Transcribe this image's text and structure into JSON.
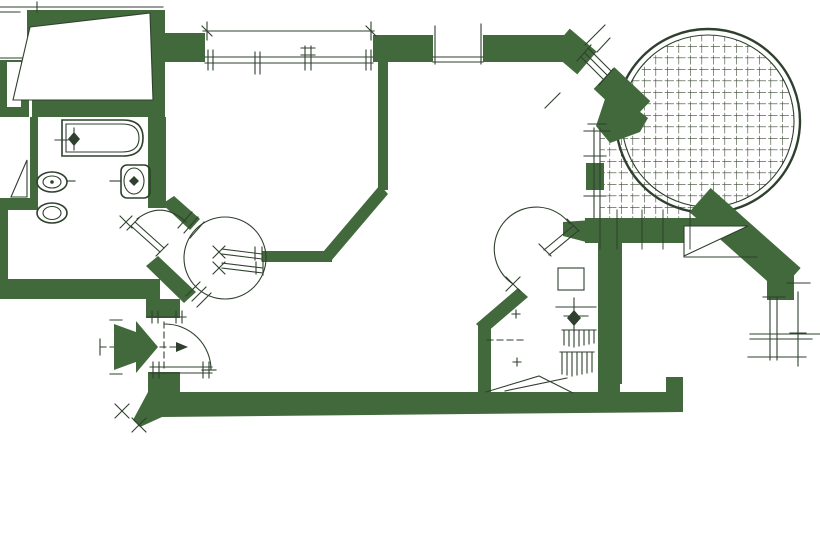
{
  "meta": {
    "kind": "architectural-floor-plan",
    "style": "scanned hand-drafted plan, dark green ink on white paper",
    "text_labels": []
  },
  "palette": {
    "background": "#ffffff",
    "wall_fill": "#42693c",
    "line": "#2f402e",
    "grid_line": "#3a4733"
  },
  "plan": {
    "rooms": [
      {
        "name": "bathroom",
        "fixtures": [
          "bathtub",
          "bidet",
          "toilet",
          "washbasin"
        ]
      },
      {
        "name": "top-room"
      },
      {
        "name": "living-area"
      },
      {
        "name": "hall-vestibule"
      },
      {
        "name": "small-room",
        "fixtures": [
          "boiler",
          "radiator-combs"
        ]
      },
      {
        "name": "circular-terrace",
        "floor": "square-tile-grid"
      }
    ],
    "doors": [
      {
        "name": "bathroom-door",
        "type": "single-swing"
      },
      {
        "name": "vestibule-swing-door",
        "type": "double-action, full-circle swing"
      },
      {
        "name": "small-room-door",
        "type": "single-swing"
      },
      {
        "name": "entrance-door",
        "type": "single-swing with entry arrow"
      }
    ],
    "windows": [
      {
        "name": "top-window-large"
      },
      {
        "name": "top-window-small"
      },
      {
        "name": "diagonal-terrace-window"
      },
      {
        "name": "terrace-side-window"
      },
      {
        "name": "right-side-window"
      }
    ],
    "symbols": [
      "entrance-arrow",
      "dimension-ticks",
      "hinge-cross-marks",
      "door-jamb-hatches"
    ]
  }
}
